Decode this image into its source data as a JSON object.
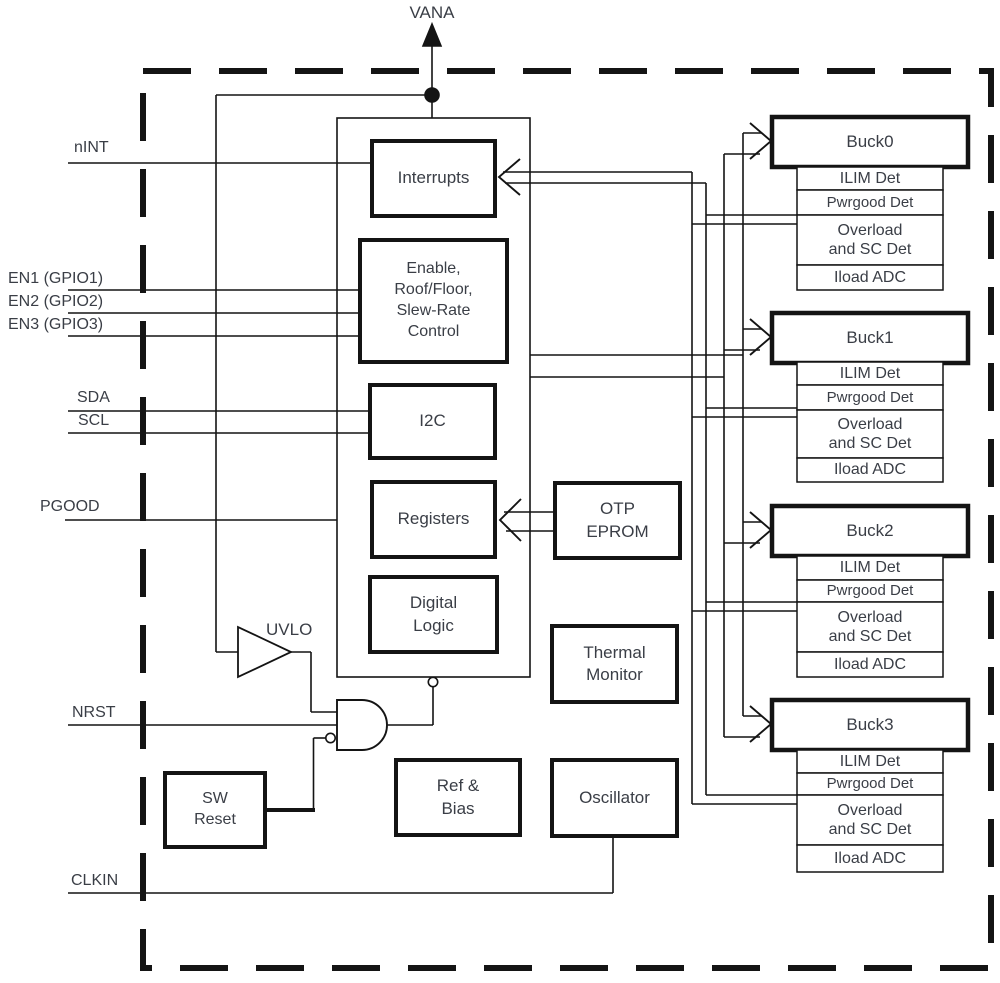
{
  "pins": {
    "vana": "VANA",
    "nint": "nINT",
    "en1": "EN1 (GPIO1)",
    "en2": "EN2 (GPIO2)",
    "en3": "EN3 (GPIO3)",
    "sda": "SDA",
    "scl": "SCL",
    "pgood": "PGOOD",
    "nrst": "NRST",
    "clkin": "CLKIN"
  },
  "blocks": {
    "interrupts": "Interrupts",
    "enable_control": "Enable,\nRoof/Floor,\nSlew-Rate\nControl",
    "i2c": "I2C",
    "registers": "Registers",
    "digital_logic": "Digital\nLogic",
    "otp_eprom": "OTP\nEPROM",
    "thermal_monitor": "Thermal\nMonitor",
    "ref_bias": "Ref &\nBias",
    "oscillator": "Oscillator",
    "sw_reset": "SW\nReset",
    "uvlo": "UVLO"
  },
  "bucks": [
    {
      "name": "Buck0",
      "rows": [
        "ILIM Det",
        "Pwrgood Det",
        "Overload\nand SC Det",
        "Iload ADC"
      ]
    },
    {
      "name": "Buck1",
      "rows": [
        "ILIM Det",
        "Pwrgood Det",
        "Overload\nand SC Det",
        "Iload ADC"
      ]
    },
    {
      "name": "Buck2",
      "rows": [
        "ILIM Det",
        "Pwrgood Det",
        "Overload\nand SC Det",
        "Iload ADC"
      ]
    },
    {
      "name": "Buck3",
      "rows": [
        "ILIM Det",
        "Pwrgood Det",
        "Overload\nand SC Det",
        "Iload ADC"
      ]
    }
  ],
  "colors": {
    "line": "#141414",
    "text": "#3a3e46",
    "background": "#ffffff"
  }
}
